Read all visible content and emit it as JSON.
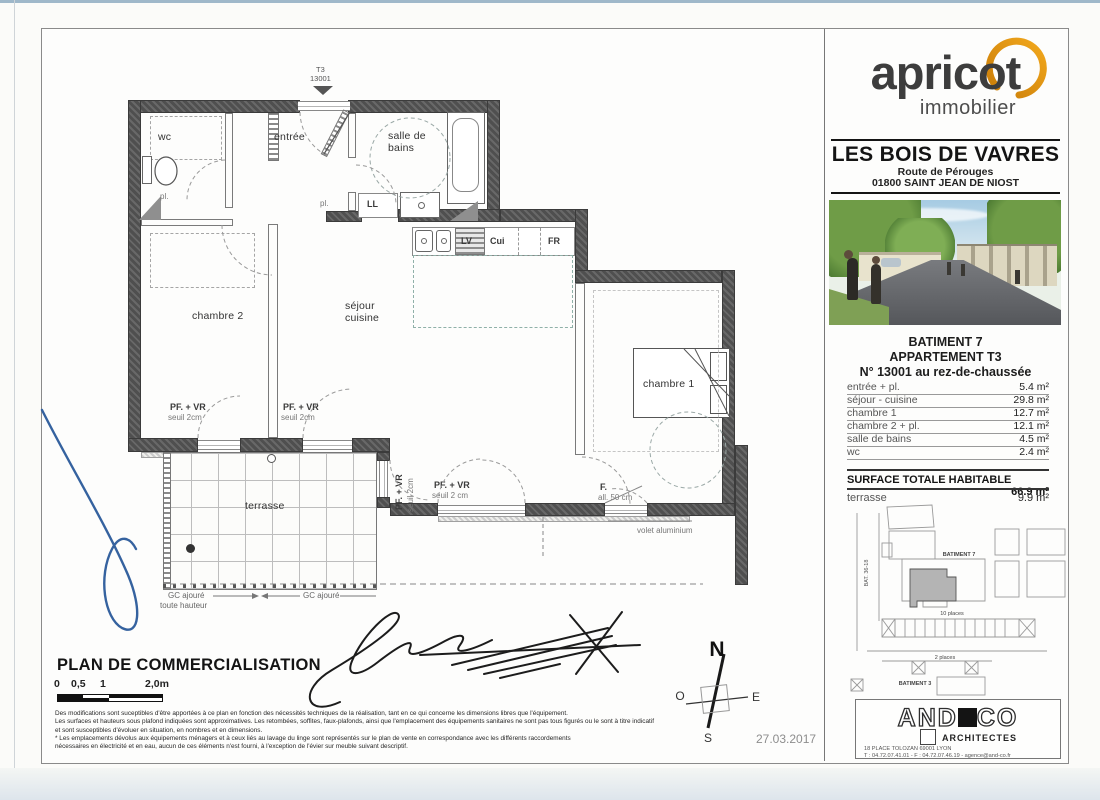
{
  "meta": {
    "date": "27.03.2017"
  },
  "brand": {
    "name": "apricot",
    "tagline": "immobilier"
  },
  "project": {
    "title": "LES BOIS DE VAVRES",
    "address1": "Route de Pérouges",
    "address2": "01800 SAINT JEAN DE NIOST"
  },
  "unit": {
    "building": "BATIMENT 7",
    "type": "APPARTEMENT T3",
    "number": "N° 13001 au rez-de-chaussée"
  },
  "areas": {
    "rows": [
      {
        "label": "entrée + pl.",
        "value": "5.4 m²"
      },
      {
        "label": "séjour - cuisine",
        "value": "29.8 m²"
      },
      {
        "label": "chambre 1",
        "value": "12.7 m²"
      },
      {
        "label": "chambre 2 + pl.",
        "value": "12.1 m²"
      },
      {
        "label": "salle de bains",
        "value": "4.5 m²"
      },
      {
        "label": "wc",
        "value": "2.4 m²"
      }
    ],
    "total_label": "SURFACE TOTALE HABITABLE",
    "total_value": "66.9 m²",
    "terrace_label": "terrasse",
    "terrace_value": "9.9 m²"
  },
  "siteplan": {
    "batiment7": "BATIMENT 7",
    "places10": "10 places",
    "places2": "2 places",
    "batiment3": "BATIMENT 3",
    "bat_left": "BAT. 36-18"
  },
  "architect": {
    "and": "AND",
    "co": "CO",
    "subtitle": "ARCHITECTES",
    "address": "18 PLACE TOLOZAN 69001 LYON",
    "contact": "T : 04.72.07.41.01 - F : 04.72.07.46.19 - agence@and-co.fr"
  },
  "plan": {
    "tag_type": "T3",
    "tag_num": "13001",
    "rooms": {
      "wc": "wc",
      "entree": "entrée",
      "sdb": "salle de\nbains",
      "ch2": "chambre 2",
      "sejour": "séjour\ncuisine",
      "ch1": "chambre 1",
      "terrasse": "terrasse"
    },
    "labels": {
      "pl1": "pl.",
      "pl2": "pl.",
      "ll": "LL",
      "lv": "LV",
      "cui": "Cui",
      "fr": "FR",
      "pfvr": "PF. + VR",
      "seuil": "seuil 2cm",
      "seuil_sp": "seuil 2 cm",
      "f": "F.",
      "all50": "all. 50 cm",
      "volet": "volet aluminium",
      "gc_left_1": "GC ajouré",
      "gc_left_2": "toute hauteur",
      "gc_right": "GC ajouré"
    }
  },
  "compass": {
    "n": "N",
    "s": "S",
    "e": "E",
    "o": "O"
  },
  "footer": {
    "title": "PLAN DE COMMERCIALISATION",
    "scale_ticks": [
      "0",
      "0,5",
      "1",
      "2,0m"
    ],
    "legal": [
      "Des modifications sont suceptibles d'être apportées à ce plan en fonction des nécessités techniques de la réalisation, tant en ce qui concerne les dimensions libres que l'équipement.",
      "Les surfaces et hauteurs sous plafond indiquées sont approximatives. Les retombées, soffites, faux-plafonds, ainsi que l'emplacement des équipements sanitaires ne sont pas tous figurés ou le sont à titre indicatif",
      "et sont susceptibles d'évoluer en situation, en nombres et en dimensions.",
      "* Les emplacements dévolus aux équipements ménagers et à ceux liés au lavage du linge sont représentés sur le plan de vente en correspondance avec les différents raccordements",
      "nécessaires en électricité et en eau, aucun de ces éléments n'est fourni, à l'exception de l'évier sur meuble suivant descriptif."
    ]
  }
}
